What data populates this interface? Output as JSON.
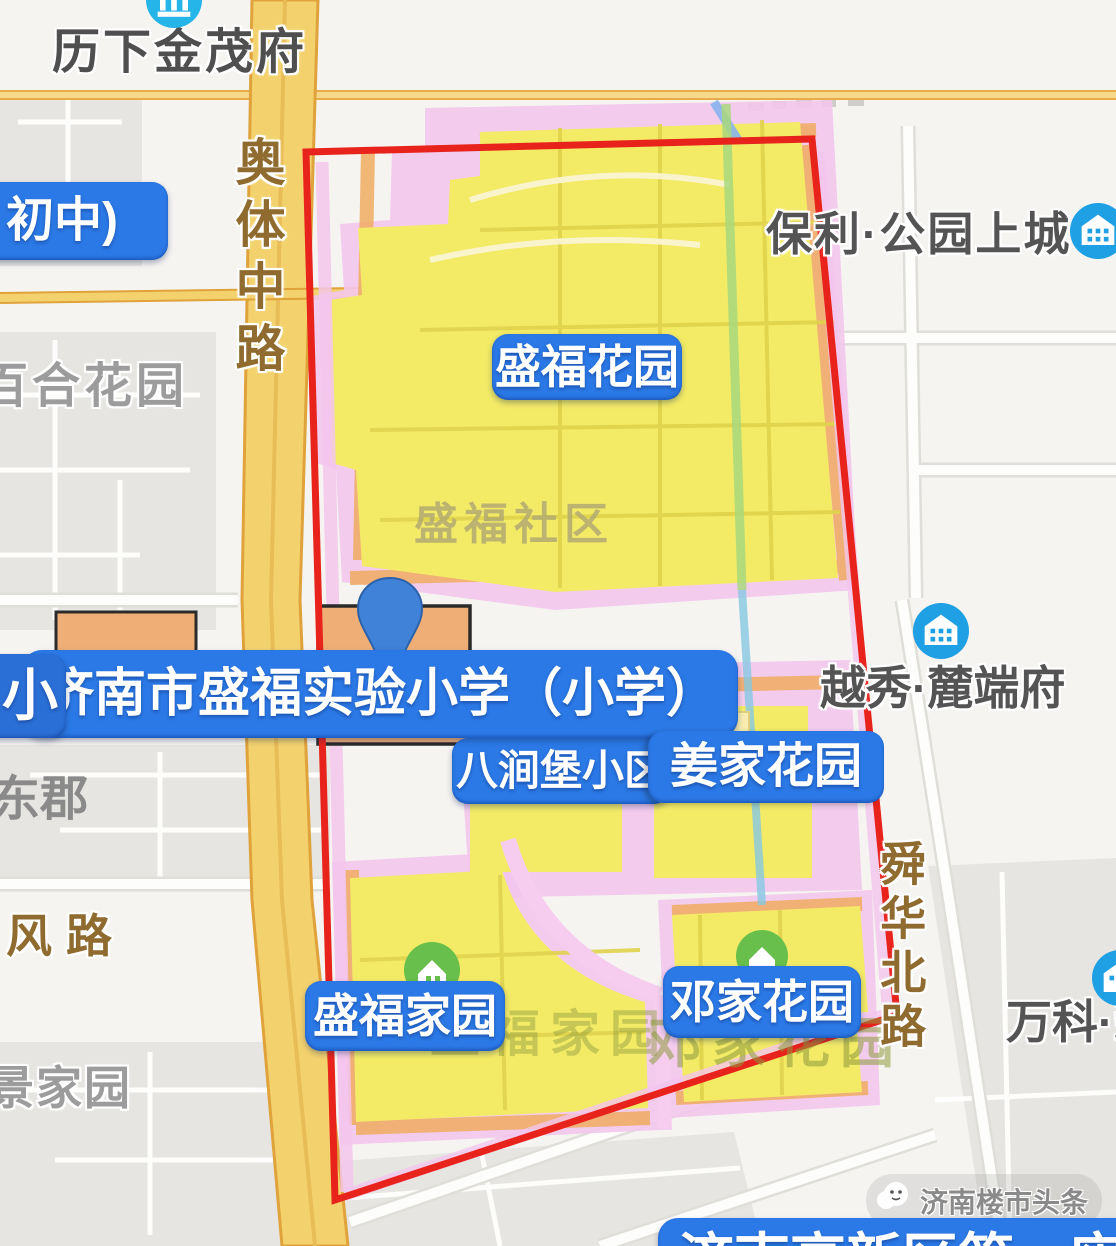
{
  "map": {
    "labels": {
      "lixia_jinmao": "历下金茂府",
      "aoti_road": "奥体中路",
      "baihe": "百合花园",
      "baoli": "保利·公园上城",
      "shengfu_shequ": "盛福社区",
      "yuexiu": "越秀·麓端府",
      "dongjun": "东郡",
      "feng_road": "风路",
      "jingjiayuan": "景家园",
      "wanke": "万科·翡",
      "shunhua_road": "舜华北路",
      "dengjia_ghost": "邓家花园",
      "shengfu_jiayuan_ghost": "盛福家园"
    },
    "badges": {
      "chuzhong": "初中)",
      "shengfu_huayuan": "盛福花园",
      "school_frag": "小",
      "school": "济南市盛福实验小学（小学）",
      "bajianpu": "八涧堡小区",
      "jiangjia": "姜家花园",
      "shengfu_jiayuan": "盛福家园",
      "dengjia": "邓家花园",
      "bottom_school": "济南高新区第一实验学校"
    },
    "watermark": "济南楼市头条",
    "colors": {
      "district_boundary": "#e8231c",
      "zone_fill": "#f3eb66",
      "zone_halo": "#f3c6ec",
      "zone_band_orange": "#f0ab60",
      "badge_blue": "#2b79e6",
      "road_yellow": "#f3d26e",
      "poi_blue": "#1fa0e4",
      "poi_cyan": "#26b5e8",
      "poi_green": "#69bf4c"
    }
  }
}
